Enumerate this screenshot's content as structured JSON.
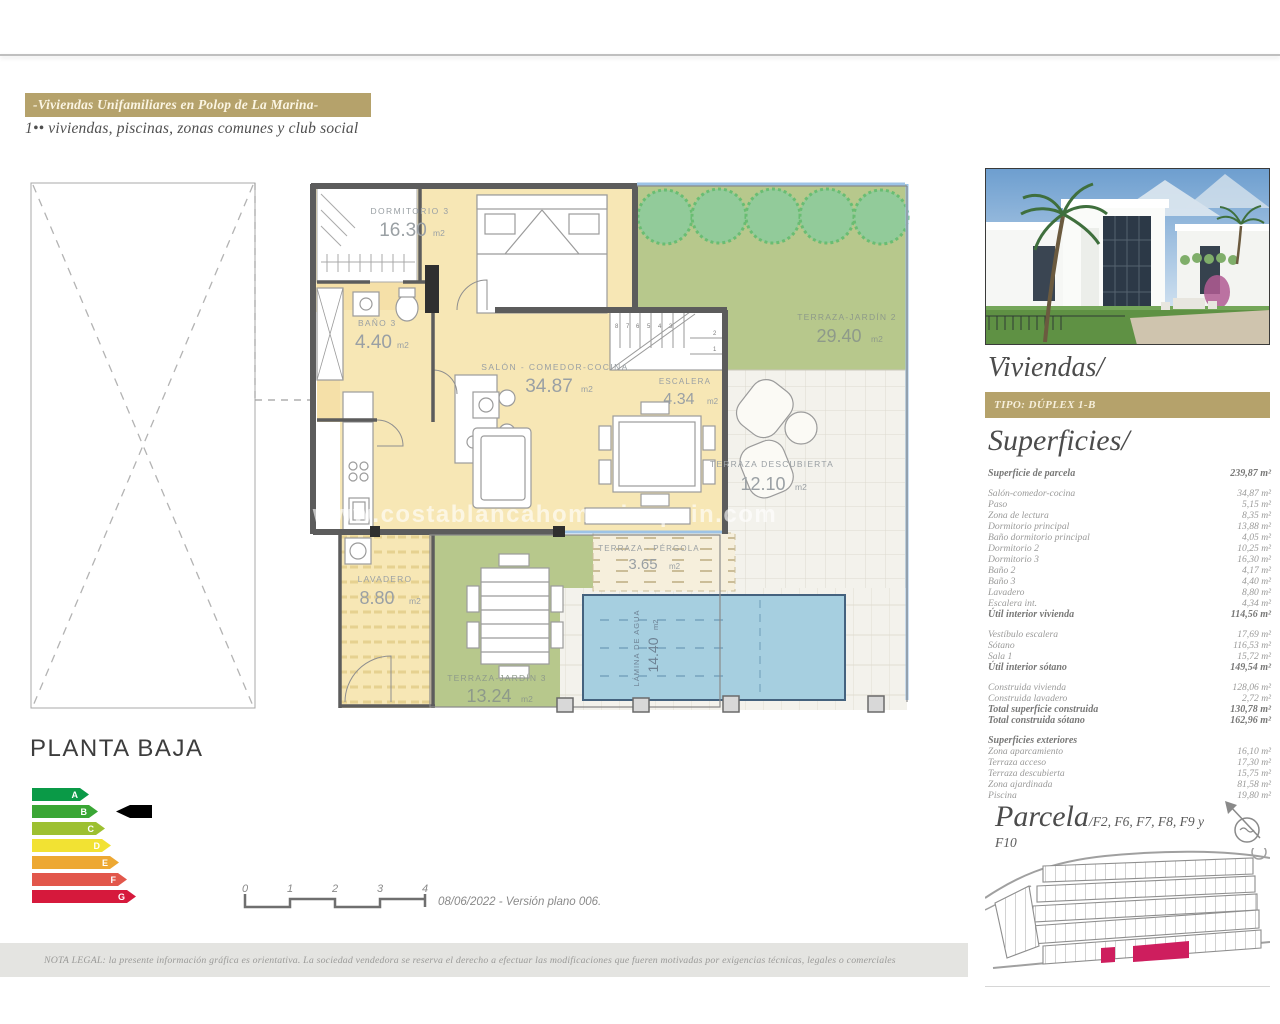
{
  "header": {
    "banner": "-Viviendas Unifamiliares en Polop de La Marina-",
    "subtitle": "1•• viviendas, piscinas, zonas comunes y club social"
  },
  "plan": {
    "title": "PLANTA BAJA",
    "watermark": "www.costablancahomesinspain.com",
    "unit": "m2",
    "rooms": {
      "dormitorio3": {
        "name": "DORMITORIO 3",
        "area": "16.30"
      },
      "bano3": {
        "name": "BAÑO 3",
        "area": "4.40"
      },
      "salon": {
        "name": "SALÓN - COMEDOR-COCINA",
        "area": "34.87"
      },
      "escalera": {
        "name": "ESCALERA",
        "area": "4.34"
      },
      "jardin2": {
        "name": "TERRAZA-JARDÍN 2",
        "area": "29.40"
      },
      "descubierta": {
        "name": "TERRAZA DESCUBIERTA",
        "area": "12.10"
      },
      "pergola": {
        "name": "TERRAZA - PÉRGOLA",
        "area": "3.65"
      },
      "lavadero": {
        "name": "LAVADERO",
        "area": "8.80"
      },
      "jardin3": {
        "name": "TERRAZA-JARDÍN 3",
        "area": "13.24"
      },
      "lamina": {
        "name": "LÁMINA DE AGUA",
        "area": "14.40"
      }
    },
    "stairs": [
      "8",
      "7",
      "6",
      "5",
      "4",
      "3",
      "2",
      "1"
    ]
  },
  "energy": {
    "levels": [
      {
        "label": "A",
        "color": "#0a9a47"
      },
      {
        "label": "B",
        "color": "#3aa635"
      },
      {
        "label": "C",
        "color": "#9dc031"
      },
      {
        "label": "D",
        "color": "#f2e233"
      },
      {
        "label": "E",
        "color": "#eda832"
      },
      {
        "label": "F",
        "color": "#e2574b"
      },
      {
        "label": "G",
        "color": "#d6193c"
      }
    ],
    "indicator_level": "B"
  },
  "scalebar": {
    "ticks": [
      "0",
      "1",
      "2",
      "3",
      "4"
    ],
    "caption": "08/06/2022 - Versión plano 006."
  },
  "sidebar": {
    "viviendas_title": "Viviendas/",
    "tipo_badge": "TIPO: DÚPLEX 1-B",
    "superficies_title": "Superficies/",
    "table": {
      "groups": [
        {
          "rows": [
            {
              "label": "Superficie de parcela",
              "value": "239,87 m²",
              "bold": true
            }
          ]
        },
        {
          "rows": [
            {
              "label": "Salón-comedor-cocina",
              "value": "34,87 m²"
            },
            {
              "label": "Paso",
              "value": "5,15 m²"
            },
            {
              "label": "Zona de lectura",
              "value": "8,35 m²"
            },
            {
              "label": "Dormitorio principal",
              "value": "13,88 m²"
            },
            {
              "label": "Baño dormitorio principal",
              "value": "4,05 m²"
            },
            {
              "label": "Dormitorio 2",
              "value": "10,25 m²"
            },
            {
              "label": "Dormitorio 3",
              "value": "16,30 m²"
            },
            {
              "label": "Baño 2",
              "value": "4,17 m²"
            },
            {
              "label": "Baño 3",
              "value": "4,40 m²"
            },
            {
              "label": "Lavadero",
              "value": "8,80 m²"
            },
            {
              "label": "Escalera int.",
              "value": "4,34 m²"
            },
            {
              "label": "Útil interior vivienda",
              "value": "114,56 m²",
              "bold": true
            }
          ]
        },
        {
          "rows": [
            {
              "label": "Vestíbulo escalera",
              "value": "17,69 m²"
            },
            {
              "label": "Sótano",
              "value": "116,53 m²"
            },
            {
              "label": "Sala 1",
              "value": "15,72 m²"
            },
            {
              "label": "Útil interior sótano",
              "value": "149,54 m²",
              "bold": true
            }
          ]
        },
        {
          "rows": [
            {
              "label": "Construida vivienda",
              "value": "128,06 m²"
            },
            {
              "label": "Construida lavadero",
              "value": "2,72 m²"
            },
            {
              "label": "Total superficie construida",
              "value": "130,78 m²",
              "bold": true
            },
            {
              "label": "Total construida sótano",
              "value": "162,96 m²",
              "bold": true
            }
          ]
        },
        {
          "header": "Superficies exteriores",
          "rows": [
            {
              "label": "Zona aparcamiento",
              "value": "16,10 m²"
            },
            {
              "label": "Terraza acceso",
              "value": "17,30 m²"
            },
            {
              "label": "Terraza descubierta",
              "value": "15,75 m²"
            },
            {
              "label": "Zona ajardinada",
              "value": "81,58 m²"
            },
            {
              "label": "Piscina",
              "value": "19,80 m²"
            }
          ]
        }
      ]
    },
    "parcela_title": "Parcela",
    "parcela_sub": "/F2, F6, F7, F8, F9 y F10"
  },
  "footer": {
    "legal": "NOTA LEGAL: la presente información gráfica es orientativa. La sociedad vendedora se reserva el derecho a efectuar las modificaciones que fueren motivadas por exigencias técnicas, legales o comerciales"
  }
}
